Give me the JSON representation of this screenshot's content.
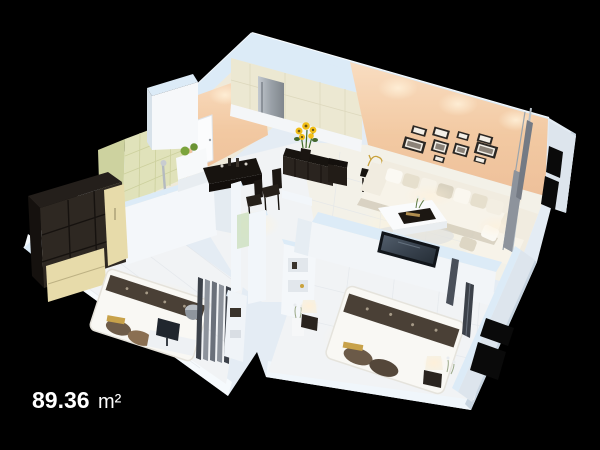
{
  "area_label": {
    "value": "89.36",
    "unit": "m²"
  },
  "colors": {
    "background": "#000000",
    "wall_top": "#dcebf7",
    "wall_white": "#f2f6fa",
    "floor": "#f1f3f5",
    "peach": "#f1c6a0",
    "peach_light": "#f8dcc0",
    "tile_green": "#e0e2ba",
    "tile_cream": "#ece8d2",
    "dark_wood": "#2a241f",
    "sofa": "#f1ece0",
    "bed": "#f9f8f4",
    "runner": "#4a4036",
    "curtain_gray": "#8d939c",
    "curtain_dark": "#3c4149",
    "window_black": "#0a0a0a",
    "cream_door": "#e7dbaa",
    "steel": "#aab1b8",
    "sunflower": "#f2be17",
    "topiary_green": "#7ba43c",
    "lamp_glow": "#ffe9c4"
  }
}
